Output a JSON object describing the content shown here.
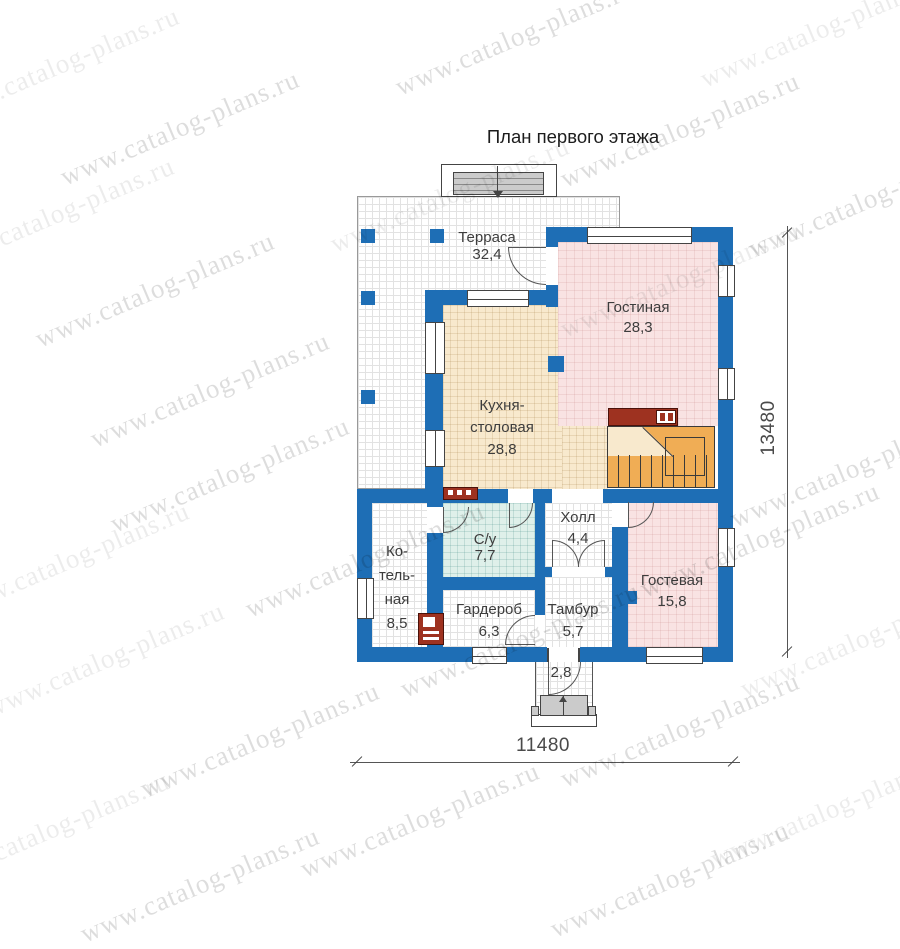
{
  "title": "План первого этажа",
  "watermark": {
    "text": "www.catalog-plans.ru",
    "instances": [
      {
        "x": 60,
        "y": 65,
        "s": "l"
      },
      {
        "x": 515,
        "y": 38,
        "s": "d"
      },
      {
        "x": 820,
        "y": 30,
        "s": "l"
      },
      {
        "x": 180,
        "y": 128,
        "s": "d"
      },
      {
        "x": 680,
        "y": 130,
        "s": "d"
      },
      {
        "x": 55,
        "y": 215,
        "s": "l"
      },
      {
        "x": 450,
        "y": 195,
        "s": "l"
      },
      {
        "x": 868,
        "y": 200,
        "s": "d"
      },
      {
        "x": 155,
        "y": 290,
        "s": "d"
      },
      {
        "x": 680,
        "y": 280,
        "s": "l"
      },
      {
        "x": 210,
        "y": 390,
        "s": "d"
      },
      {
        "x": 850,
        "y": 470,
        "s": "d"
      },
      {
        "x": 230,
        "y": 475,
        "s": "d"
      },
      {
        "x": 70,
        "y": 560,
        "s": "l"
      },
      {
        "x": 365,
        "y": 560,
        "s": "d"
      },
      {
        "x": 760,
        "y": 540,
        "s": "d"
      },
      {
        "x": 105,
        "y": 660,
        "s": "l"
      },
      {
        "x": 520,
        "y": 640,
        "s": "d"
      },
      {
        "x": 860,
        "y": 640,
        "s": "l"
      },
      {
        "x": 260,
        "y": 740,
        "s": "d"
      },
      {
        "x": 680,
        "y": 730,
        "s": "d"
      },
      {
        "x": 50,
        "y": 830,
        "s": "l"
      },
      {
        "x": 420,
        "y": 820,
        "s": "d"
      },
      {
        "x": 830,
        "y": 810,
        "s": "l"
      },
      {
        "x": 200,
        "y": 885,
        "s": "d"
      },
      {
        "x": 670,
        "y": 880,
        "s": "d"
      }
    ]
  },
  "dimensions": {
    "width_label": "11480",
    "height_label": "13480"
  },
  "rooms": {
    "terrace": {
      "name": "Терраса",
      "area": "32,4"
    },
    "living": {
      "name": "Гостиная",
      "area": "28,3"
    },
    "kitchen": {
      "line1": "Кухня-",
      "line2": "столовая",
      "area": "28,8"
    },
    "hall": {
      "name": "Холл",
      "area": "4,4"
    },
    "bathroom": {
      "name": "С/у",
      "area": "7,7"
    },
    "boiler": {
      "line1": "Ко-",
      "line2": "тель-",
      "line3": "ная",
      "area": "8,5"
    },
    "wardrobe": {
      "name": "Гардероб",
      "area": "6,3"
    },
    "vestibule": {
      "name": "Тамбур",
      "area": "5,7"
    },
    "guest": {
      "name": "Гостевая",
      "area": "15,8"
    },
    "porch": {
      "area": "2,8"
    }
  },
  "colors": {
    "wall": "#1e6eb5",
    "kitchen-floor": "#f8e9cd",
    "living-floor": "#f9e3e3",
    "bath-floor": "#dff0ea",
    "stairs": "#f0ad55",
    "brick": "#9e3220"
  }
}
